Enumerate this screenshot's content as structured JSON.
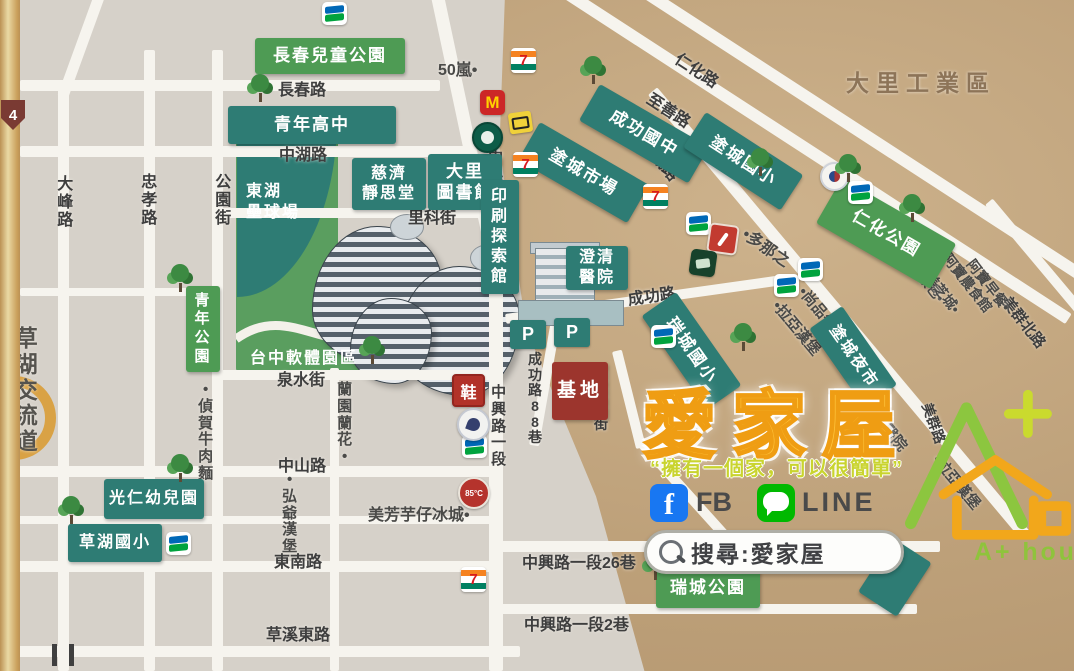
{
  "map": {
    "shield": "4",
    "special": {
      "dome": "東湖\n壘球場",
      "software": "台中軟體園區"
    },
    "roads": [
      {
        "n": "road-curve-top-left",
        "x": 95,
        "y": -8,
        "w": 11,
        "h": 110,
        "r": 20
      },
      {
        "n": "road-dafeng",
        "x": 58,
        "y": 88,
        "w": 11,
        "h": 583
      },
      {
        "n": "road-zhongxiao",
        "x": 144,
        "y": 50,
        "w": 11,
        "h": 621
      },
      {
        "n": "road-gongyuan-st",
        "x": 212,
        "y": 50,
        "w": 11,
        "h": 621
      },
      {
        "n": "road-lanyuan-st",
        "x": 330,
        "y": 368,
        "w": 9,
        "h": 303
      },
      {
        "n": "road-zhongxing-top",
        "x": 430,
        "y": -8,
        "w": 13,
        "h": 290,
        "r": -12
      },
      {
        "n": "road-zhongxing-main",
        "x": 489,
        "y": 268,
        "w": 14,
        "h": 403
      },
      {
        "n": "road-changchun",
        "x": 20,
        "y": 80,
        "w": 420,
        "h": 11
      },
      {
        "n": "road-zhonghu",
        "x": 20,
        "y": 146,
        "w": 445,
        "h": 11
      },
      {
        "n": "road-like-st",
        "x": 212,
        "y": 208,
        "w": 288,
        "h": 10
      },
      {
        "n": "road-quanshui-st",
        "x": 212,
        "y": 370,
        "w": 288,
        "h": 10
      },
      {
        "n": "road-minor-left",
        "x": 20,
        "y": 288,
        "w": 192,
        "h": 8
      },
      {
        "n": "road-zhongshan",
        "x": 0,
        "y": 466,
        "w": 502,
        "h": 11
      },
      {
        "n": "road-minor-south",
        "x": 0,
        "y": 516,
        "w": 502,
        "h": 8
      },
      {
        "n": "road-dongnan",
        "x": 0,
        "y": 561,
        "w": 502,
        "h": 11
      },
      {
        "n": "road-caoxi-east",
        "x": 0,
        "y": 646,
        "w": 520,
        "h": 11
      },
      {
        "n": "road-lane26",
        "x": 497,
        "y": 541,
        "w": 443,
        "h": 11
      },
      {
        "n": "road-lane2",
        "x": 497,
        "y": 604,
        "w": 420,
        "h": 10
      },
      {
        "n": "road-lane88",
        "x": 556,
        "y": 292,
        "w": 10,
        "h": 155,
        "r": 10
      },
      {
        "n": "road-ruicheng-1st",
        "x": 612,
        "y": 352,
        "w": 10,
        "h": 100,
        "r": -14
      },
      {
        "n": "road-ruicheng-1st-curve",
        "x": 634,
        "y": 442,
        "w": 10,
        "h": 140,
        "r": -42
      },
      {
        "n": "road-renhua",
        "x": 600,
        "y": -30,
        "w": 12,
        "h": 580,
        "r": -57
      },
      {
        "n": "road-zhishan",
        "x": 520,
        "y": -30,
        "w": 12,
        "h": 650,
        "r": -57
      },
      {
        "n": "road-tucheng",
        "x": 648,
        "y": 95,
        "w": 12,
        "h": 580,
        "r": -40
      },
      {
        "n": "road-meiqun-north",
        "x": 985,
        "y": 205,
        "w": 10,
        "h": 200,
        "r": -40
      },
      {
        "n": "road-chenggong",
        "x": 505,
        "y": 314,
        "w": 280,
        "h": 10,
        "r": -8
      }
    ],
    "labels": [
      {
        "t": "長春路",
        "x": 278,
        "y": 76,
        "n": "road-label-changchun"
      },
      {
        "t": "中湖路",
        "x": 279,
        "y": 141,
        "n": "road-label-zhonghu"
      },
      {
        "t": "里科街",
        "x": 408,
        "y": 204,
        "n": "road-label-like-st"
      },
      {
        "t": "泉水街",
        "x": 277,
        "y": 366,
        "n": "road-label-quanshui-st"
      },
      {
        "t": "中山路",
        "x": 278,
        "y": 452,
        "n": "road-label-zhongshan"
      },
      {
        "t": "東南路",
        "x": 274,
        "y": 548,
        "n": "road-label-dongnan"
      },
      {
        "t": "草溪東路",
        "x": 266,
        "y": 621,
        "n": "road-label-caoxi-east"
      },
      {
        "t": "中興路一段26巷",
        "x": 522,
        "y": 549,
        "n": "road-label-lane26"
      },
      {
        "t": "中興路一段2巷",
        "x": 524,
        "y": 611,
        "n": "road-label-lane2"
      },
      {
        "t": "大峰路",
        "x": 56,
        "y": 176,
        "v": 1,
        "n": "road-label-dafeng"
      },
      {
        "t": "忠孝路",
        "x": 140,
        "y": 174,
        "v": 1,
        "n": "road-label-zhongxiao"
      },
      {
        "t": "公園街",
        "x": 214,
        "y": 174,
        "v": 1,
        "n": "road-label-gongyuan-st"
      },
      {
        "t": "中興路一段",
        "x": 487,
        "y": 150,
        "v": 1,
        "s": 15,
        "n": "road-label-zhongxing-north"
      },
      {
        "t": "中興路一段",
        "x": 490,
        "y": 385,
        "v": 1,
        "s": 15,
        "n": "road-label-zhongxing-south"
      },
      {
        "t": "成功路88巷",
        "x": 527,
        "y": 352,
        "v": 1,
        "s": 14,
        "n": "road-label-lane88"
      },
      {
        "t": "瑞城一街",
        "x": 593,
        "y": 370,
        "v": 1,
        "s": 14,
        "n": "road-label-ruicheng-1st"
      },
      {
        "t": "草湖交流道",
        "x": 13,
        "y": 326,
        "v": 1,
        "s": 23,
        "c": "#55534e",
        "n": "label-caohu-interchange"
      },
      {
        "t": "成功路",
        "x": 626,
        "y": 286,
        "r": -8,
        "n": "road-label-chenggong"
      },
      {
        "t": "仁化路",
        "x": 684,
        "y": 46,
        "r": 33,
        "n": "road-label-renhua"
      },
      {
        "t": "至善路",
        "x": 656,
        "y": 86,
        "r": 33,
        "n": "road-label-zhishan"
      },
      {
        "t": "塗城路",
        "x": 655,
        "y": 133,
        "r": 50,
        "n": "road-label-tucheng"
      },
      {
        "t": "美群北路",
        "x": 1014,
        "y": 292,
        "r": 52,
        "s": 15,
        "n": "road-label-meiqun-north"
      },
      {
        "t": "美群路",
        "x": 936,
        "y": 400,
        "r": 70,
        "s": 14,
        "n": "road-label-meiqun"
      },
      {
        "t": "大里工業區",
        "x": 846,
        "y": 64,
        "s": 23,
        "c": "#8d7458",
        "ls": 7,
        "n": "district-label-dali-industrial"
      }
    ],
    "poi_texts": [
      {
        "t": "50嵐•",
        "x": 438,
        "y": 56,
        "n": "poi-50lan"
      },
      {
        "t": "•偵賀牛肉麵",
        "x": 197,
        "y": 382,
        "v": 1,
        "s": 15,
        "n": "poi-zhenhe-beef-noodle"
      },
      {
        "t": "蘭園蘭花•",
        "x": 336,
        "y": 382,
        "v": 1,
        "s": 15,
        "n": "poi-lanyuan-orchid"
      },
      {
        "t": "•弘爺漢堡",
        "x": 281,
        "y": 472,
        "v": 1,
        "s": 15,
        "n": "poi-hongye-burger"
      },
      {
        "t": "美芳芋仔冰城•",
        "x": 368,
        "y": 501,
        "s": 16,
        "n": "poi-meifang-taro-ice"
      },
      {
        "t": "•多那之",
        "x": 752,
        "y": 221,
        "r": 35,
        "s": 16,
        "n": "poi-donutes"
      },
      {
        "t": "•拉亞漢堡",
        "x": 784,
        "y": 296,
        "r": 50,
        "s": 15,
        "n": "poi-laya-burger"
      },
      {
        "t": "•尚品牛肉麵",
        "x": 810,
        "y": 282,
        "r": 50,
        "s": 15,
        "n": "poi-shangpin-beef-noodle"
      },
      {
        "t": "池上飯包•",
        "x": 912,
        "y": 246,
        "r": 52,
        "s": 14,
        "n": "poi-chishang-bento"
      },
      {
        "t": "美芝城•",
        "x": 936,
        "y": 268,
        "r": 52,
        "s": 14,
        "n": "poi-meizhicheng"
      },
      {
        "t": "阿寶農食館",
        "x": 954,
        "y": 249,
        "r": 52,
        "s": 14,
        "n": "poi-abao-restaurant"
      },
      {
        "t": "阿寶早餐•",
        "x": 978,
        "y": 255,
        "r": 52,
        "s": 14,
        "n": "poi-abao-breakfast"
      },
      {
        "t": "普生醫院",
        "x": 874,
        "y": 396,
        "r": 50,
        "s": 15,
        "n": "poi-pusheng-hospital"
      },
      {
        "t": "•拉亞漢堡",
        "x": 944,
        "y": 450,
        "r": 50,
        "s": 15,
        "n": "poi-laya-burger-2"
      }
    ],
    "poi_boxes": [
      {
        "t": "長春兒童公園",
        "k": "park",
        "x": 255,
        "y": 38,
        "w": 150,
        "h": 36,
        "n": "poi-changchun-childrens-park"
      },
      {
        "t": "青年高中",
        "k": "teal",
        "x": 228,
        "y": 106,
        "w": 168,
        "h": 38,
        "n": "poi-qingnian-high-school"
      },
      {
        "t": "慈濟\n靜思堂",
        "k": "teal",
        "x": 352,
        "y": 158,
        "w": 74,
        "h": 52,
        "s": 16,
        "n": "poi-tzuchi-hall"
      },
      {
        "t": "大里\n圖書館",
        "k": "teal",
        "x": 428,
        "y": 154,
        "w": 74,
        "h": 56,
        "s": 17,
        "n": "poi-dali-library"
      },
      {
        "t": "印刷探索館",
        "k": "teal",
        "x": 481,
        "y": 180,
        "w": 38,
        "h": 114,
        "v": 1,
        "s": 16,
        "n": "poi-printing-museum"
      },
      {
        "t": "澄清\n醫院",
        "k": "teal",
        "x": 566,
        "y": 246,
        "w": 62,
        "h": 44,
        "s": 16,
        "n": "poi-chengching-hospital"
      },
      {
        "t": "成功國中",
        "k": "teal",
        "x": 600,
        "y": 84,
        "w": 126,
        "h": 42,
        "r": 30,
        "n": "poi-chenggong-junior-high"
      },
      {
        "t": "塗城市場",
        "k": "teal",
        "x": 540,
        "y": 122,
        "w": 126,
        "h": 44,
        "r": 30,
        "n": "poi-tucheng-market"
      },
      {
        "t": "塗城國小",
        "k": "teal",
        "x": 706,
        "y": 112,
        "w": 116,
        "h": 42,
        "r": 33,
        "n": "poi-tucheng-elementary"
      },
      {
        "t": "仁化公園",
        "k": "park",
        "x": 842,
        "y": 178,
        "w": 132,
        "h": 52,
        "r": 30,
        "n": "poi-renhua-park"
      },
      {
        "t": "瑞城國小",
        "k": "teal",
        "x": 676,
        "y": 292,
        "w": 114,
        "h": 42,
        "r": 55,
        "n": "poi-ruicheng-elementary"
      },
      {
        "t": "塗城夜市",
        "k": "teal",
        "x": 842,
        "y": 306,
        "w": 96,
        "h": 40,
        "r": 55,
        "s": 16,
        "n": "poi-tucheng-night-market"
      },
      {
        "t": "青年公園",
        "k": "park",
        "x": 186,
        "y": 286,
        "w": 34,
        "h": 86,
        "v": 1,
        "s": 15,
        "n": "poi-qingnian-park"
      },
      {
        "t": "光仁幼兒園",
        "k": "teal",
        "x": 104,
        "y": 479,
        "w": 100,
        "h": 40,
        "s": 16,
        "n": "poi-guangren-kindergarten"
      },
      {
        "t": "草湖國小",
        "k": "teal",
        "x": 68,
        "y": 524,
        "w": 94,
        "h": 38,
        "s": 16,
        "n": "poi-caohu-elementary"
      },
      {
        "t": "瑞城公園",
        "k": "park",
        "x": 656,
        "y": 568,
        "w": 104,
        "h": 40,
        "n": "poi-ruicheng-park"
      },
      {
        "t": "基地",
        "k": "red",
        "x": 552,
        "y": 362,
        "w": 56,
        "h": 58,
        "s": 19,
        "n": "poi-site"
      },
      {
        "t": "",
        "k": "deco",
        "x": 893,
        "y": 538,
        "w": 46,
        "h": 64,
        "r": 33,
        "n": "poi-unlabeled-box"
      }
    ],
    "icons": [
      {
        "k": "famima",
        "x": 322,
        "y": 2
      },
      {
        "k": "famima",
        "x": 848,
        "y": 181
      },
      {
        "k": "famima",
        "x": 686,
        "y": 212
      },
      {
        "k": "famima",
        "x": 651,
        "y": 325
      },
      {
        "k": "famima",
        "x": 774,
        "y": 274
      },
      {
        "k": "famima",
        "x": 798,
        "y": 258
      },
      {
        "k": "famima",
        "x": 462,
        "y": 435
      },
      {
        "k": "famima",
        "x": 166,
        "y": 532
      },
      {
        "k": "seven",
        "x": 511,
        "y": 48,
        "l": "7"
      },
      {
        "k": "seven",
        "x": 513,
        "y": 152,
        "l": "7"
      },
      {
        "k": "seven",
        "x": 643,
        "y": 184,
        "l": "7"
      },
      {
        "k": "seven",
        "x": 461,
        "y": 567,
        "l": "7"
      },
      {
        "k": "mcd",
        "x": 480,
        "y": 90,
        "l": "M"
      },
      {
        "k": "sbux",
        "x": 472,
        "y": 122
      },
      {
        "k": "yellow",
        "x": 509,
        "y": 112
      },
      {
        "k": "c85",
        "x": 458,
        "y": 477,
        "l": "85°C"
      },
      {
        "k": "shoe",
        "x": 452,
        "y": 374,
        "l": "鞋"
      },
      {
        "k": "roundbadge",
        "x": 457,
        "y": 408
      },
      {
        "k": "redstore",
        "x": 708,
        "y": 224
      },
      {
        "k": "greenstore",
        "x": 690,
        "y": 250
      },
      {
        "k": "schoolbadge",
        "x": 820,
        "y": 162
      },
      {
        "k": "p",
        "x": 510,
        "y": 320,
        "l": "P"
      },
      {
        "k": "p",
        "x": 554,
        "y": 318,
        "l": "P"
      }
    ],
    "trees": [
      {
        "x": 246,
        "y": 74
      },
      {
        "x": 166,
        "y": 264
      },
      {
        "x": 358,
        "y": 336
      },
      {
        "x": 166,
        "y": 454
      },
      {
        "x": 57,
        "y": 496
      },
      {
        "x": 641,
        "y": 552
      },
      {
        "x": 579,
        "y": 56
      },
      {
        "x": 746,
        "y": 148
      },
      {
        "x": 834,
        "y": 154
      },
      {
        "x": 898,
        "y": 194
      },
      {
        "x": 729,
        "y": 323
      }
    ]
  },
  "brand": {
    "title": "愛家屋",
    "slogan": "“擁有一個家，可以很簡單”",
    "fb_glyph": "f",
    "fb": "FB",
    "line": "LINE",
    "search": "搜尋:愛家屋",
    "logo_text": "A+ house"
  }
}
